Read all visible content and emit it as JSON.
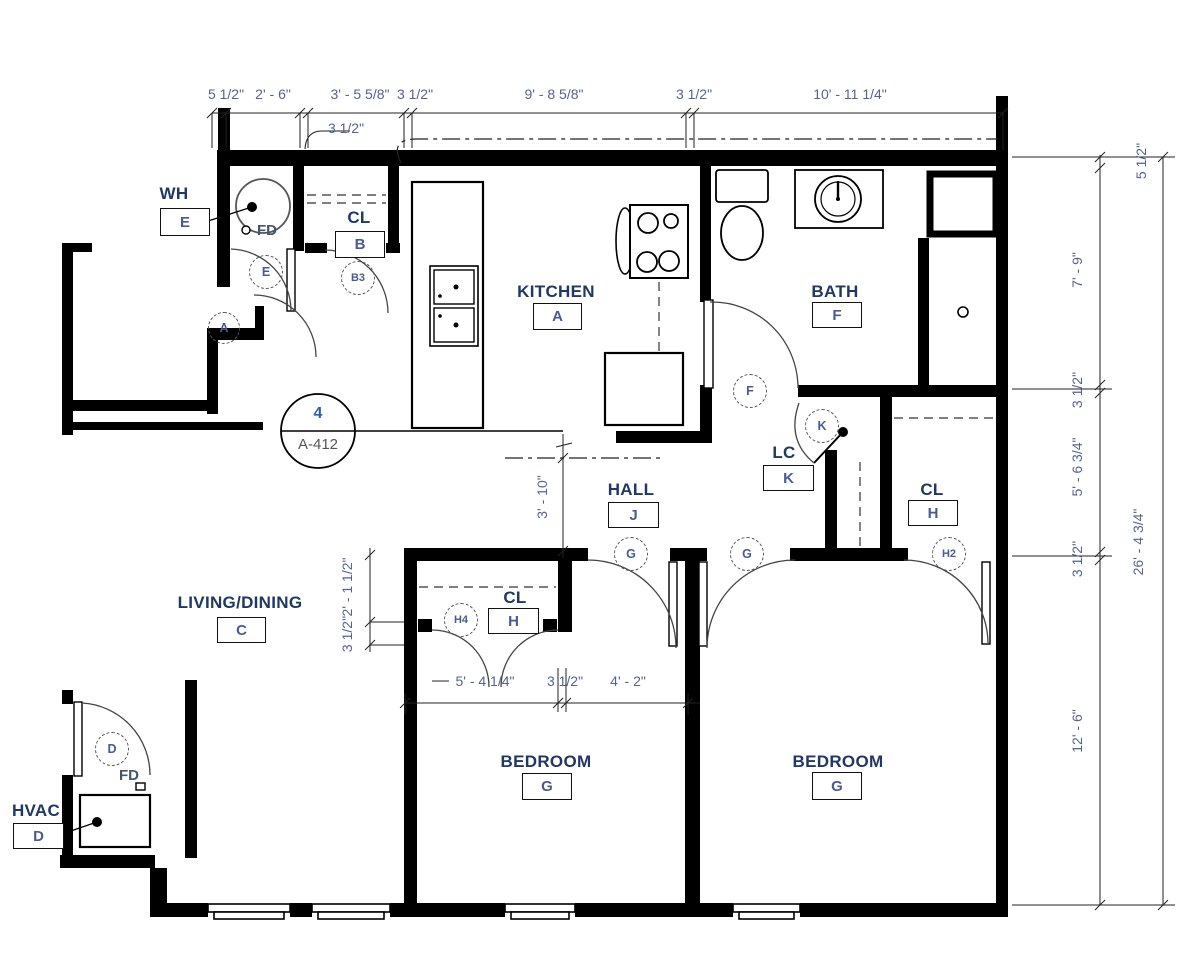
{
  "plan": {
    "rooms": {
      "wh": {
        "name": "WH",
        "tag": "E"
      },
      "cl_b": {
        "name": "CL",
        "tag": "B"
      },
      "kitchen": {
        "name": "KITCHEN",
        "tag": "A"
      },
      "bath": {
        "name": "BATH",
        "tag": "F"
      },
      "lc": {
        "name": "LC",
        "tag": "K"
      },
      "hall": {
        "name": "HALL",
        "tag": "J"
      },
      "cl_h": {
        "name": "CL",
        "tag": "H"
      },
      "living": {
        "name": "LIVING/DINING",
        "tag": "C"
      },
      "cl_h4": {
        "name": "CL",
        "tag": "H"
      },
      "bedroom1": {
        "name": "BEDROOM",
        "tag": "G"
      },
      "bedroom2": {
        "name": "BEDROOM",
        "tag": "G"
      },
      "hvac": {
        "name": "HVAC",
        "tag": "D"
      }
    },
    "doors": {
      "e": "E",
      "b3": "B3",
      "a": "A",
      "f": "F",
      "k": "K",
      "g1": "G",
      "g2": "G",
      "h2": "H2",
      "h4": "H4",
      "d": "D"
    },
    "callout": {
      "number": "4",
      "sheet": "A-412"
    },
    "fd": {
      "wh": "FD",
      "hvac": "FD"
    },
    "dims": {
      "top1": "5 1/2\"",
      "top2": "2' - 6\"",
      "top3": "3' - 5 5/8\"",
      "top4": "3 1/2\"",
      "top5": "9' - 8 5/8\"",
      "top6": "3 1/2\"",
      "top7": "10' - 11 1/4\"",
      "wall_leader": "3 1/2\"",
      "right1": "5 1/2\"",
      "right2": "7' - 9\"",
      "right3": "3 1/2\"",
      "right4": "5' - 6 3/4\"",
      "right5": "3 1/2\"",
      "right6": "12' - 6\"",
      "right_total": "26' - 4 3/4\"",
      "hall_depth": "3' - 10\"",
      "closet1": "2' - 1 1/2\"",
      "closet2": "3 1/2\"",
      "bed1": "5' - 4 1/4\"",
      "bed2": "3 1/2\"",
      "bed3": "4' - 2\""
    }
  }
}
